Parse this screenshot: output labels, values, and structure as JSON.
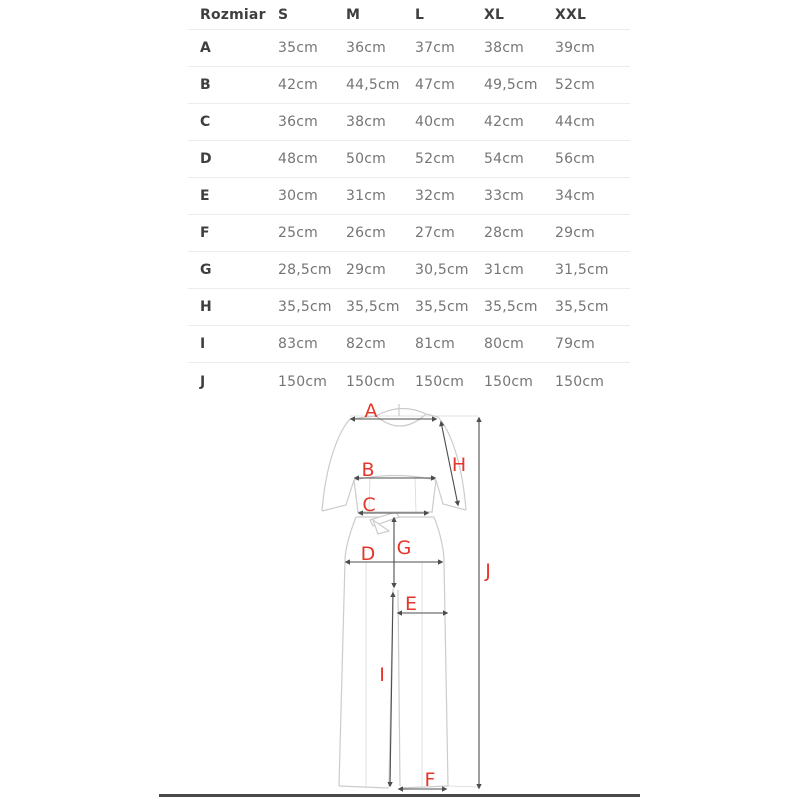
{
  "colors": {
    "accent_red": "#e5362b",
    "line_dark": "#4d4d4d",
    "garment_line": "#cccccc",
    "divider": "#ececec",
    "header_text": "#3f3f3f",
    "value_text": "#757575",
    "bottom_bar": "#4a4a4a"
  },
  "size_table": {
    "header": {
      "label": "Rozmiar",
      "sizes": [
        "S",
        "M",
        "L",
        "XL",
        "XXL"
      ]
    },
    "rows": [
      {
        "dimension": "A",
        "values": [
          "35cm",
          "36cm",
          "37cm",
          "38cm",
          "39cm"
        ]
      },
      {
        "dimension": "B",
        "values": [
          "42cm",
          "44,5cm",
          "47cm",
          "49,5cm",
          "52cm"
        ]
      },
      {
        "dimension": "C",
        "values": [
          "36cm",
          "38cm",
          "40cm",
          "42cm",
          "44cm"
        ]
      },
      {
        "dimension": "D",
        "values": [
          "48cm",
          "50cm",
          "52cm",
          "54cm",
          "56cm"
        ]
      },
      {
        "dimension": "E",
        "values": [
          "30cm",
          "31cm",
          "32cm",
          "33cm",
          "34cm"
        ]
      },
      {
        "dimension": "F",
        "values": [
          "25cm",
          "26cm",
          "27cm",
          "28cm",
          "29cm"
        ]
      },
      {
        "dimension": "G",
        "values": [
          "28,5cm",
          "29cm",
          "30,5cm",
          "31cm",
          "31,5cm"
        ]
      },
      {
        "dimension": "H",
        "values": [
          "35,5cm",
          "35,5cm",
          "35,5cm",
          "35,5cm",
          "35,5cm"
        ]
      },
      {
        "dimension": "I",
        "values": [
          "83cm",
          "82cm",
          "81cm",
          "80cm",
          "79cm"
        ]
      },
      {
        "dimension": "J",
        "values": [
          "150cm",
          "150cm",
          "150cm",
          "150cm",
          "150cm"
        ]
      }
    ]
  },
  "diagram": {
    "type": "garment-measurement-diagram",
    "garment": "short-sleeve wide-leg jumpsuit, front view",
    "labels": {
      "A": "A",
      "B": "B",
      "C": "C",
      "D": "D",
      "E": "E",
      "F": "F",
      "G": "G",
      "H": "H",
      "I": "I",
      "J": "J"
    }
  }
}
